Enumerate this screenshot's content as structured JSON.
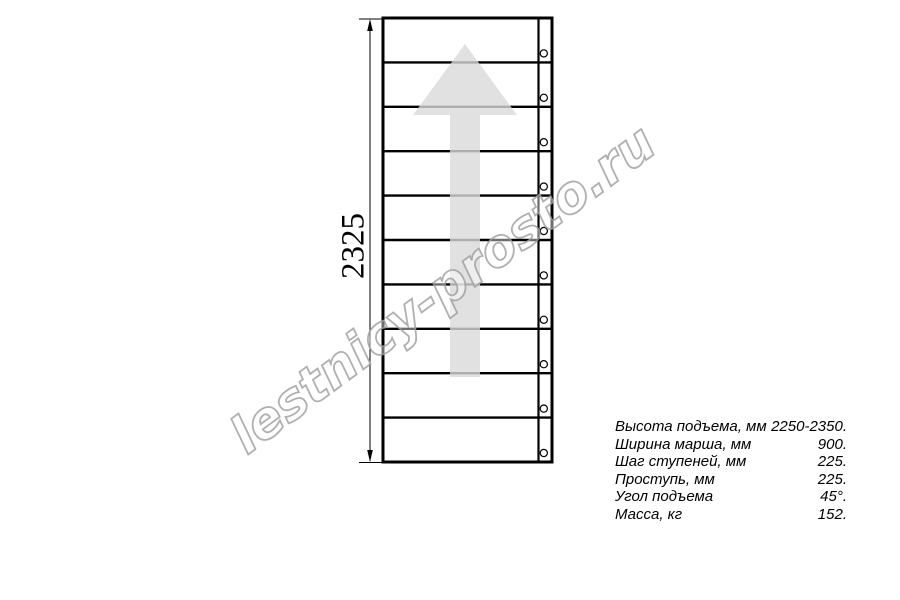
{
  "watermark": {
    "text": "lestnicy-prosto.ru",
    "color": "#a3a3a3"
  },
  "drawing": {
    "type": "staircase-plan-top-view",
    "dimension_label": "2325",
    "steps_count": 10,
    "line_color": "#000000",
    "arrow_color": "#d9d9d9"
  },
  "specs": {
    "rows": [
      {
        "label": "Высота подъема, мм",
        "value": "2250-2350."
      },
      {
        "label": "Ширина марша, мм",
        "value": "900."
      },
      {
        "label": "Шаг ступеней, мм",
        "value": "225."
      },
      {
        "label": "Проступь, мм",
        "value": "225."
      },
      {
        "label": "Угол подъема",
        "value": "45°."
      },
      {
        "label": "Масса, кг",
        "value": "152."
      }
    ]
  }
}
